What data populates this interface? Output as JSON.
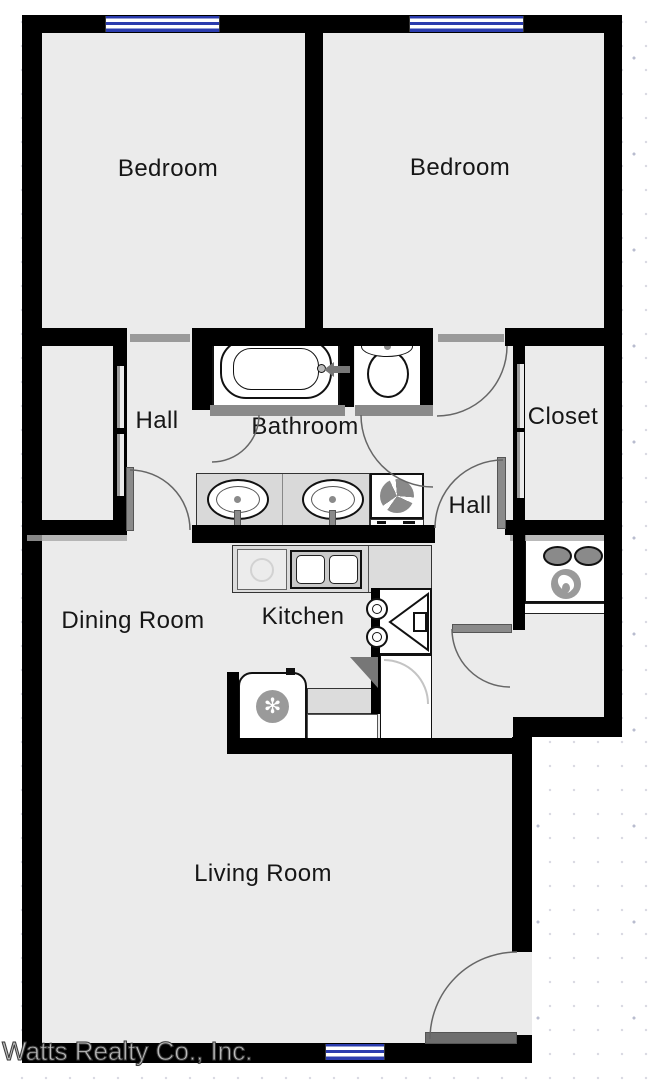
{
  "document": {
    "type": "apartment-floor-plan",
    "watermark": "Watts Realty Co., Inc."
  },
  "colors": {
    "wall": "#000000",
    "interior_fill": "#ebebeb",
    "exterior": "#ffffff",
    "window_blue": "#2b3cae",
    "door_gray": "#8a8a8a",
    "counter_gray": "#dcdcdc",
    "label_text": "#161616",
    "watermark_gray": "#bdbdbd"
  },
  "rooms": {
    "bedroom_left": {
      "label": "Bedroom"
    },
    "bedroom_right": {
      "label": "Bedroom"
    },
    "hall_left": {
      "label": "Hall"
    },
    "bathroom": {
      "label": "Bathroom"
    },
    "closet": {
      "label": "Closet"
    },
    "hall_right": {
      "label": "Hall"
    },
    "dining": {
      "label": "Dining Room"
    },
    "kitchen": {
      "label": "Kitchen"
    },
    "living": {
      "label": "Living Room"
    }
  },
  "fixtures": {
    "bathtub": "bathtub-icon",
    "toilet": "toilet-icon",
    "vanity": "double-vanity-sink-icon",
    "washer": "washer-fan-icon",
    "water_heater": "water-heater-flame-icon",
    "kitchen_sink": "kitchen-double-sink-icon",
    "dishwasher": "dishwasher-icon",
    "stove": "stove-hood-icon",
    "refrigerator": "refrigerator-snowflake-icon",
    "window_count": 3,
    "door_arc_count": 7
  }
}
